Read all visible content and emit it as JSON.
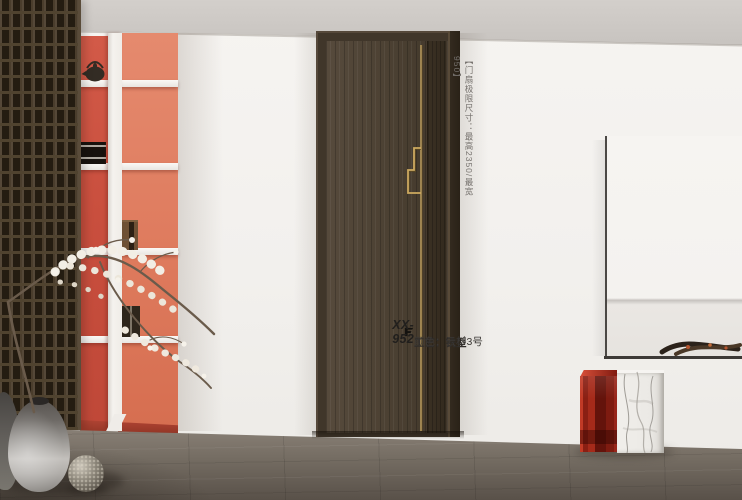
{
  "scene": {
    "spec_note": "【门扇极限尺寸：最高2350/最宽950】",
    "product": {
      "model": "XX-952",
      "craft": "工艺：铣型",
      "color": "颜色：云杉3号"
    },
    "icons": {
      "brand_logo": "brand-logo-icon"
    },
    "palette": {
      "accent_red": "#cc5342",
      "accent_salmon": "#e08164",
      "door_wood": "#4a3f31",
      "door_frame": "#40362a",
      "gold": "#c9a75f",
      "wall_white": "#f3f1ee",
      "ceiling_gray": "#cbc7c3",
      "floor_gray": "#766e64",
      "acrylic_red": "#8e1f14",
      "marble_white": "#ebe9e5"
    }
  }
}
